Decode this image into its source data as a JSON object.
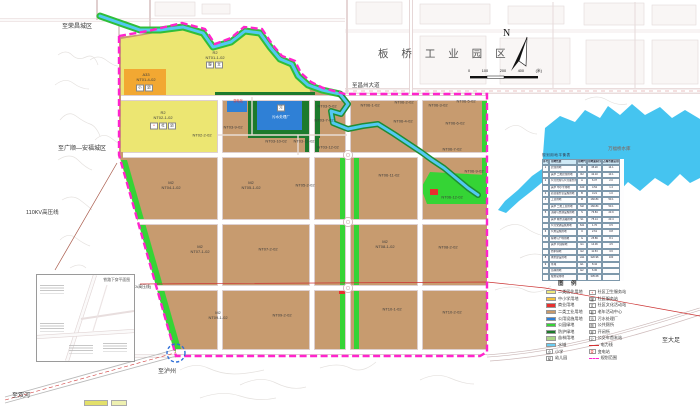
{
  "map": {
    "region_title": "板 桥 工 业 园 区",
    "reservoir_label": "万福桥水库",
    "north_label": "N",
    "scale": {
      "ticks": [
        "0",
        "100",
        "200",
        "400"
      ],
      "unit": "(米)"
    },
    "roads": {
      "rongchang": "至荣昌城区",
      "changzhou": "至昌州大道",
      "guangshun": "至广顺—安福城区",
      "luzhou": "至泸州",
      "shuanghe": "至双河",
      "dazu": "至大足",
      "powerline": "110KV高压线",
      "powerline2": "(110KV高压线)"
    },
    "inset_title": "铁路下穿平面图",
    "parcels": [
      {
        "t": "R2\nNT01-1-02",
        "x": 215,
        "y": 56
      },
      {
        "t": "A33\nNT01-4-02",
        "x": 146,
        "y": 78
      },
      {
        "t": "R2\nNT02-1-02",
        "x": 163,
        "y": 116
      },
      {
        "t": "NT02-2-02",
        "x": 202,
        "y": 136
      },
      {
        "t": "NT03-9-02",
        "x": 233,
        "y": 128
      },
      {
        "t": "NT03-10-02",
        "x": 276,
        "y": 142
      },
      {
        "t": "NT03-11-02",
        "x": 304,
        "y": 142
      },
      {
        "t": "NT03-12-02",
        "x": 328,
        "y": 148
      },
      {
        "t": "NT03-5-02",
        "x": 327,
        "y": 107
      },
      {
        "t": "NT03-7-02",
        "x": 324,
        "y": 121
      },
      {
        "t": "污水处理厂",
        "x": 281,
        "y": 117,
        "c": "#ffffff",
        "s": 3.6
      },
      {
        "t": "变电站",
        "x": 238,
        "y": 102,
        "c": "#e03030",
        "s": 3.2
      },
      {
        "t": "NT06-1-02",
        "x": 370,
        "y": 106
      },
      {
        "t": "NT06-2-02",
        "x": 404,
        "y": 103
      },
      {
        "t": "NT06-3-02",
        "x": 438,
        "y": 106
      },
      {
        "t": "NT06-5-02",
        "x": 466,
        "y": 102
      },
      {
        "t": "NT06-4-02",
        "x": 403,
        "y": 122
      },
      {
        "t": "NT06-6-02",
        "x": 455,
        "y": 124
      },
      {
        "t": "NT06-7-02",
        "x": 452,
        "y": 150
      },
      {
        "t": "NT06-11-02",
        "x": 389,
        "y": 176
      },
      {
        "t": "NT06-9-02",
        "x": 474,
        "y": 172
      },
      {
        "t": "NT06-12-02",
        "x": 452,
        "y": 198
      },
      {
        "t": "M2\nNT04-1-02",
        "x": 171,
        "y": 186
      },
      {
        "t": "M2\nNT05-1-02",
        "x": 251,
        "y": 186
      },
      {
        "t": "NT05-2-02",
        "x": 305,
        "y": 186
      },
      {
        "t": "M2\nNT07-1-02",
        "x": 200,
        "y": 250
      },
      {
        "t": "NT07-2-02",
        "x": 268,
        "y": 250
      },
      {
        "t": "M2\nNT08-1-02",
        "x": 385,
        "y": 245
      },
      {
        "t": "NT08-2-02",
        "x": 448,
        "y": 248
      },
      {
        "t": "M2\nNT09-1-02",
        "x": 218,
        "y": 316
      },
      {
        "t": "NT09-2-02",
        "x": 282,
        "y": 316
      },
      {
        "t": "NT10-1-02",
        "x": 392,
        "y": 310
      },
      {
        "t": "NT10-2-02",
        "x": 452,
        "y": 313
      }
    ],
    "chips": [
      {
        "g": "小",
        "x": 140,
        "y": 88
      },
      {
        "g": "幼",
        "x": 149,
        "y": 88
      },
      {
        "g": "服",
        "x": 210,
        "y": 65
      },
      {
        "g": "文",
        "x": 219,
        "y": 65
      },
      {
        "g": "+",
        "x": 154,
        "y": 126,
        "gc": "#e02020"
      },
      {
        "g": "社",
        "x": 163,
        "y": 126
      },
      {
        "g": "幼",
        "x": 172,
        "y": 126
      },
      {
        "g": "污",
        "x": 281,
        "y": 108
      }
    ]
  },
  "legend": {
    "title": "图 例",
    "left": [
      {
        "sw": "#efe97c",
        "label": "二类居住用地"
      },
      {
        "sw": "#f2c23e",
        "label": "中小学用地"
      },
      {
        "sw": "#e8302e",
        "label": "商业用地"
      },
      {
        "sw": "#c8996a",
        "label": "二类工业用地"
      },
      {
        "sw": "#2f80d6",
        "label": "公用设施用地"
      },
      {
        "sw": "#35d435",
        "label": "公园绿地"
      },
      {
        "sw": "#1d7a2c",
        "label": "防护绿地"
      },
      {
        "sw": "#a9d487",
        "label": "苗林用地"
      },
      {
        "sw": "#69cdf2",
        "label": "水域"
      },
      {
        "g": "小",
        "label": "小学"
      },
      {
        "g": "幼",
        "label": "幼儿园"
      }
    ],
    "right": [
      {
        "g": "+",
        "gc": "#e01818",
        "label": "社区卫生服务站"
      },
      {
        "g": "服",
        "label": "社区服务站"
      },
      {
        "g": "文",
        "label": "社区文化活动站"
      },
      {
        "g": "老",
        "label": "老年活动中心"
      },
      {
        "g": "污",
        "label": "污水处理厂"
      },
      {
        "g": "厕",
        "label": "公共厕所"
      },
      {
        "g": "开",
        "label": "开闭所"
      },
      {
        "g": "公",
        "label": "公交车首末站"
      },
      {
        "line": "#d43333",
        "label": "电力线"
      },
      {
        "g": "变",
        "gc": "#e01818",
        "label": "变电站"
      },
      {
        "dash": "#ff24cc",
        "label": "规划范围"
      }
    ]
  },
  "table": {
    "title": "规划用地平衡表",
    "rows": [
      [
        "序号",
        "用地性质",
        "用地代码",
        "用地面积(公顷)",
        "占城市建设用地比例(%)"
      ],
      [
        "1",
        "居住用地",
        "R",
        "45.20",
        "14.1"
      ],
      [
        "",
        "其中 二类居住用地",
        "R2",
        "42.10",
        "13.1"
      ],
      [
        "2",
        "公共管理与公共服务用地",
        "A",
        "6.37",
        "2.0"
      ],
      [
        "",
        "其中 中小学用地",
        "A33",
        "4.52",
        "1.4"
      ],
      [
        "3",
        "商业服务业设施用地",
        "B",
        "3.21",
        "1.0"
      ],
      [
        "4",
        "工业用地",
        "M",
        "160.84",
        "50.1"
      ],
      [
        "",
        "其中 二类工业用地",
        "M2",
        "160.84",
        "50.1"
      ],
      [
        "5",
        "道路与交通设施用地",
        "S",
        "76.84",
        "23.9"
      ],
      [
        "",
        "其中 城市道路用地",
        "S1",
        "75.14",
        "23.4"
      ],
      [
        "",
        "公共交通设施用地",
        "S41",
        "1.70",
        "0.5"
      ],
      [
        "6",
        "公用设施用地",
        "U",
        "2.61",
        "0.8"
      ],
      [
        "7",
        "绿地与广场用地",
        "G",
        "25.89",
        "8.1"
      ],
      [
        "",
        "其中 公园绿地",
        "G1",
        "14.36",
        "4.5"
      ],
      [
        "",
        "防护绿地",
        "G2",
        "11.53",
        "3.6"
      ],
      [
        "8",
        "城市建设用地",
        "H11",
        "320.96",
        "100"
      ],
      [
        "9",
        "水域",
        "E1",
        "8.42",
        ""
      ],
      [
        "",
        "苗林用地",
        "E2",
        "6.30",
        ""
      ],
      [
        "",
        "规划总用地",
        "",
        "335.68",
        ""
      ]
    ]
  }
}
